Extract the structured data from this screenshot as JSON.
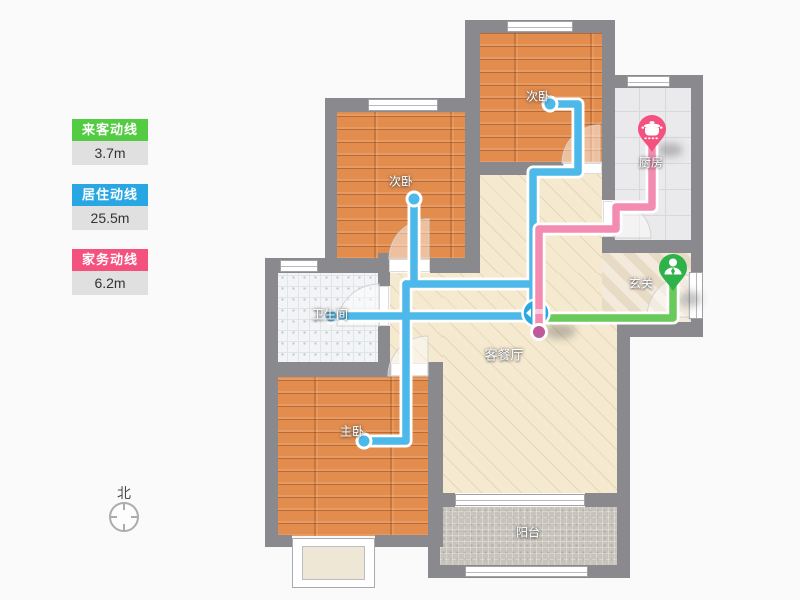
{
  "legend": {
    "items": [
      {
        "id": "guest",
        "label": "来客动线",
        "value": "3.7m"
      },
      {
        "id": "living",
        "label": "居住动线",
        "value": "25.5m"
      },
      {
        "id": "chore",
        "label": "家务动线",
        "value": "6.2m"
      }
    ]
  },
  "rooms": {
    "bedroom2_top": {
      "label": "次卧"
    },
    "kitchen": {
      "label": "厨房"
    },
    "bedroom2_left": {
      "label": "次卧"
    },
    "bathroom": {
      "label": "卫生间"
    },
    "foyer": {
      "label": "玄关"
    },
    "living": {
      "label": "客餐厅"
    },
    "master": {
      "label": "主卧"
    },
    "balcony": {
      "label": "阳台"
    }
  },
  "compass": {
    "label": "北"
  },
  "icons": {
    "kitchen_pin": "pot-icon",
    "entrance_pin": "person-icon",
    "route_marker": "arrows-icon"
  },
  "colors": {
    "green": "#53CB42",
    "green-line": "#69C95B",
    "green-pin": "#2EB24A",
    "blue": "#29A7E3",
    "blue-line": "#4CB9EA",
    "pink": "#F4517E",
    "pink-line": "#F286AC",
    "pink-cap": "#BF5A99",
    "wall": "#8A8A8E"
  }
}
